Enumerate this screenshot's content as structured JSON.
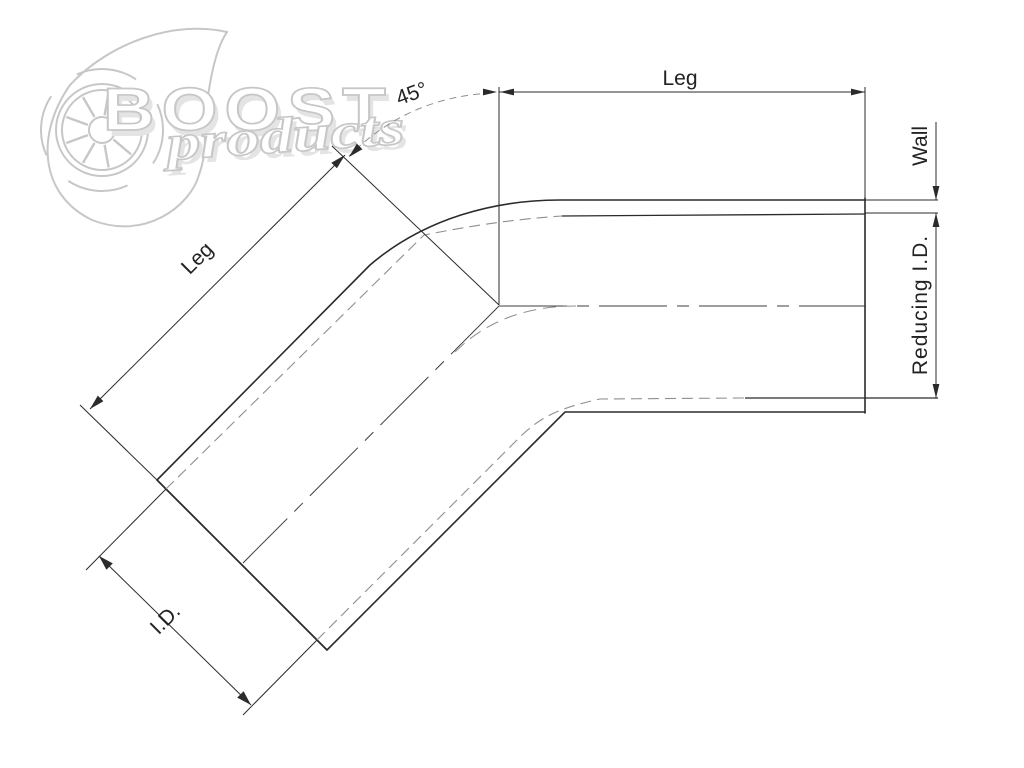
{
  "drawing": {
    "type": "technical-dimension-diagram",
    "subject": "45-degree reducing elbow silicone hose",
    "labels": {
      "angle": "45°",
      "leg_horizontal": "Leg",
      "leg_angled": "Leg",
      "wall": "Wall",
      "reducing_id": "Reducing I.D.",
      "id": "I.D."
    },
    "watermark": {
      "brand": "BOOST",
      "brand_sub": "products"
    },
    "colors": {
      "line": "#2b2b2b",
      "hidden_line": "#8f8f8f",
      "centerline": "#3c3c3c",
      "watermark": "#c7c7c7",
      "background": "#ffffff"
    }
  }
}
